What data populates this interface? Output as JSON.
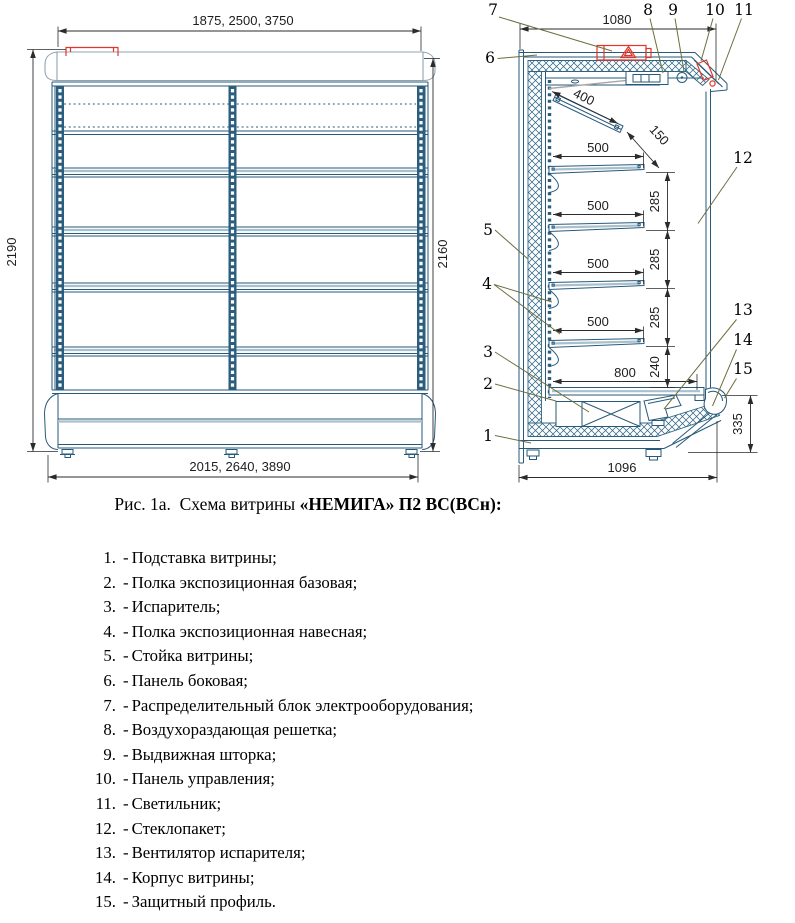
{
  "figure_caption": {
    "regular": "Рис. 1а.  Схема витрины ",
    "bold": "«НЕМИГА» П2 ВС(ВСн):"
  },
  "front_view": {
    "dim_width_top": "1875, 2500, 3750",
    "dim_width_bottom": "2015, 2640, 3890",
    "dim_height_left": "2190",
    "dim_height_right": "2160"
  },
  "side_view": {
    "dim_depth_top": "1080",
    "dim_light_length": "400",
    "dim_light_gap": "150",
    "dim_shelf_depth": "500",
    "dim_shelf_pitch": "285",
    "dim_bottom_gap": "240",
    "dim_base_shelf_depth": "800",
    "dim_front_height": "335",
    "dim_depth_bottom": "1096"
  },
  "callouts": [
    "1",
    "2",
    "3",
    "4",
    "5",
    "6",
    "7",
    "8",
    "9",
    "10",
    "11",
    "12",
    "13",
    "14",
    "15"
  ],
  "legend": {
    "separator": "-",
    "items": [
      {
        "num": "1.",
        "name": "Подставка витрины;"
      },
      {
        "num": "2.",
        "name": "Полка экспозиционная базовая;"
      },
      {
        "num": "3.",
        "name": "Испаритель;"
      },
      {
        "num": "4.",
        "name": "Полка экспозиционная навесная;"
      },
      {
        "num": "5.",
        "name": "Стойка витрины;"
      },
      {
        "num": "6.",
        "name": "Панель боковая;"
      },
      {
        "num": "7.",
        "name": "Распределительный блок электрооборудования;"
      },
      {
        "num": "8.",
        "name": "Воздухораздающая решетка;"
      },
      {
        "num": "9.",
        "name": "Выдвижная шторка;"
      },
      {
        "num": "10.",
        "name": "Панель управления;"
      },
      {
        "num": "11.",
        "name": "Светильник;"
      },
      {
        "num": "12.",
        "name": "Стеклопакет;"
      },
      {
        "num": "13.",
        "name": "Вентилятор испарителя;"
      },
      {
        "num": "14.",
        "name": "Корпус витрины;"
      },
      {
        "num": "15.",
        "name": "Защитный профиль."
      }
    ]
  },
  "colors": {
    "line_blue": "#27597a",
    "line_light_blue": "#8da3b5",
    "post_fill": "#2b5e7e",
    "dimension": "#2b2b2b",
    "leader_olive": "#6f6e3d",
    "accent_red": "#e53528"
  }
}
